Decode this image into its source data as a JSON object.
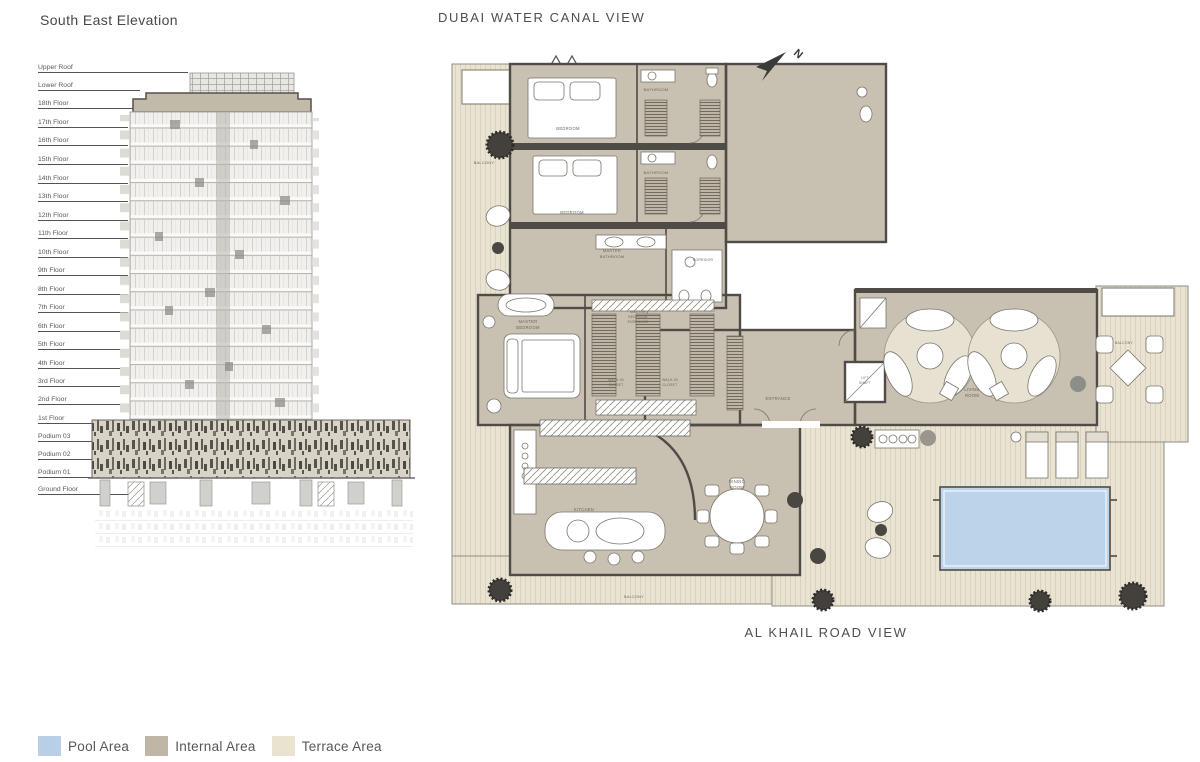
{
  "elevation": {
    "title": "South East Elevation",
    "floors": [
      "Upper Roof",
      "Lower Roof",
      "18th Floor",
      "17th Floor",
      "16th Floor",
      "15th Floor",
      "14th Floor",
      "13th Floor",
      "12th Floor",
      "11th Floor",
      "10th Floor",
      "9th Floor",
      "8th Floor",
      "7th Floor",
      "6th Floor",
      "5th Floor",
      "4th Floor",
      "3rd Floor",
      "2nd Floor",
      "1st Floor",
      "Podium 03",
      "Podium 02",
      "Podium 01",
      "Ground Floor"
    ]
  },
  "plan": {
    "top_view_label": "DUBAI WATER CANAL VIEW",
    "bottom_view_label": "AL KHAIL ROAD VIEW",
    "compass": "N",
    "rooms": {
      "balcony_left": "BALCONY",
      "bedroom_1": "BEDROOM",
      "bathroom_1": "BATHROOM",
      "bedroom_2": "BEDROOM",
      "bathroom_2": "BATHROOM",
      "master_bathroom_l1": "MASTER",
      "master_bathroom_l2": "BATHROOM",
      "corridor": "CORRIDOR",
      "mbe_l1": "MASTER",
      "mbe_l2": "BEDROOM",
      "mbe_l3": "ENTRANCE",
      "master_bedroom_l1": "MASTER",
      "master_bedroom_l2": "BEDROOM",
      "walkin_1_l1": "WALK-IN",
      "walkin_1_l2": "CLOSET",
      "walkin_2_l1": "WALK-IN",
      "walkin_2_l2": "CLOSET",
      "entrance": "ENTRANCE",
      "lift_l1": "LIFT",
      "lift_l2": "SHAFT",
      "living_l1": "LIVING",
      "living_l2": "ROOM",
      "kitchen": "KITCHEN",
      "dining_l1": "DINING",
      "dining_l2": "ROOM",
      "balcony_bottom": "BALCONY",
      "balcony_right": "BALCONY"
    }
  },
  "legend": {
    "items": [
      {
        "label": "Pool Area",
        "color": "#b9cfe8"
      },
      {
        "label": "Internal Area",
        "color": "#bfb6a5"
      },
      {
        "label": "Terrace Area",
        "color": "#e9e3d0"
      }
    ]
  },
  "colors": {
    "pool": "#bdd3e9",
    "internal": "#c8c0b0",
    "terrace": "#e9e4d2",
    "wall": "#4f4b46"
  }
}
